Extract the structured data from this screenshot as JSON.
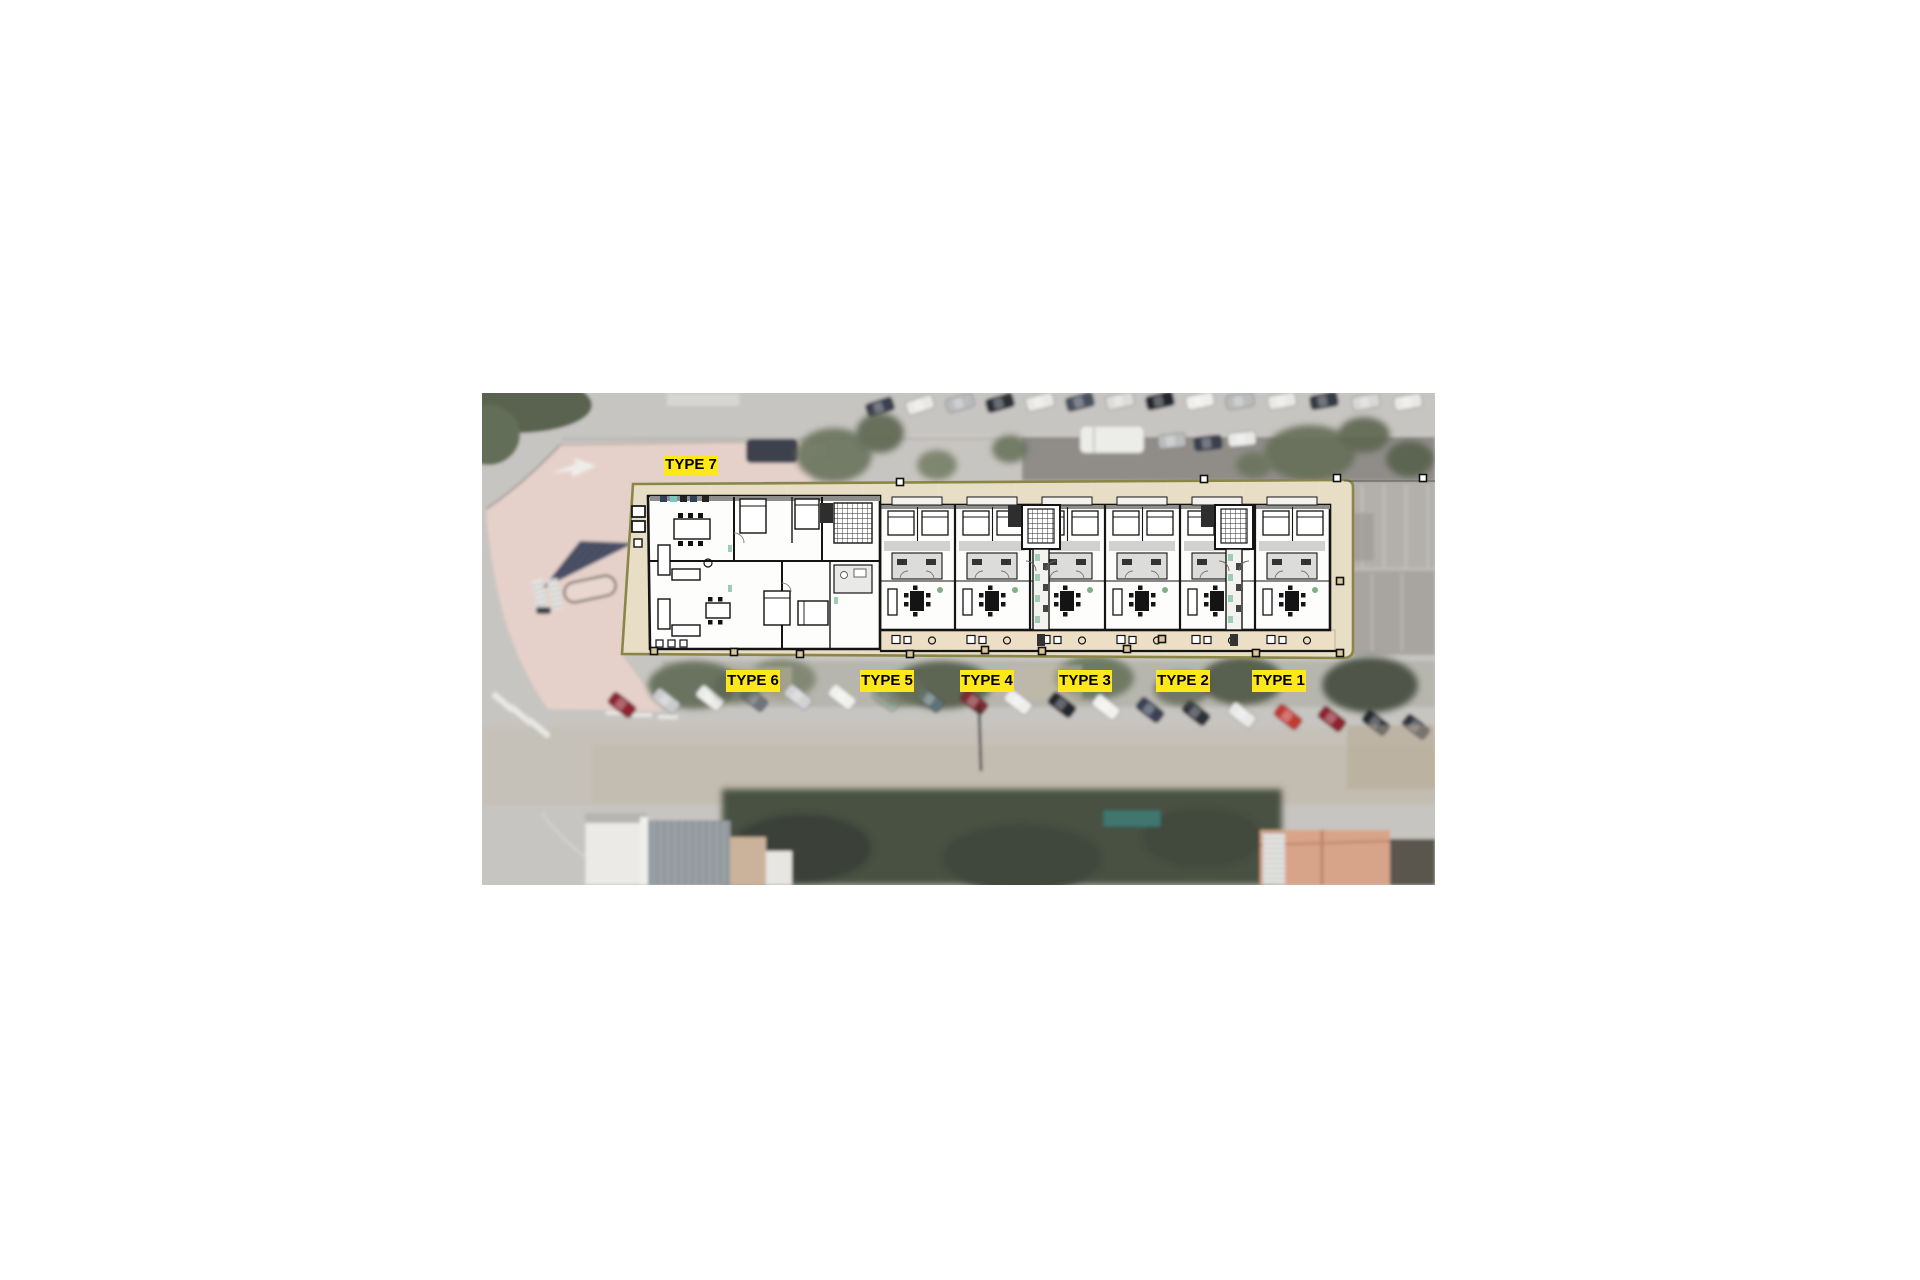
{
  "labels": {
    "type7": {
      "text": "TYPE 7"
    },
    "type6": {
      "text": "TYPE 6"
    },
    "type5": {
      "text": "TYPE 5"
    },
    "type4": {
      "text": "TYPE 4"
    },
    "type3": {
      "text": "TYPE 3"
    },
    "type2": {
      "text": "TYPE 2"
    },
    "type1": {
      "text": "TYPE 1"
    }
  },
  "colors": {
    "label_background": "#ffe81a",
    "label_text": "#000000",
    "site_boundary": "#8a8648",
    "site_fill": "#e8ddc5",
    "terrace_fill": "#ecdfc6",
    "plan_walls": "#141414",
    "photo_base": "#c7c5c1"
  }
}
